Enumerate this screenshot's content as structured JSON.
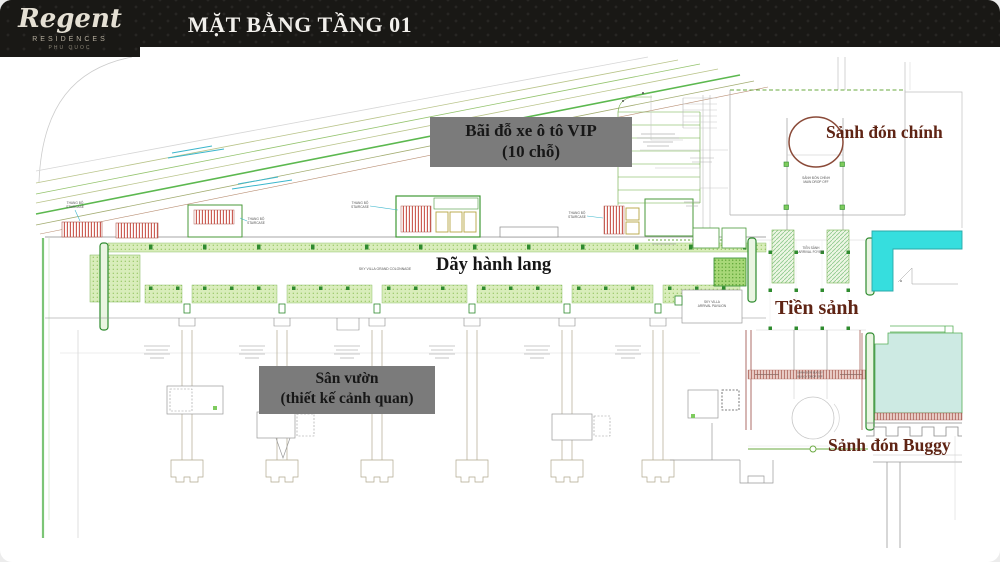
{
  "header": {
    "logo": {
      "script": "Regent",
      "residences": "RESIDENCES",
      "location": "PHU QUOC"
    },
    "title": "MẶT BẰNG TẦNG 01"
  },
  "plan": {
    "callouts": {
      "vip_parking": {
        "line1": "Bãi đỗ xe ô tô VIP",
        "line2": "(10 chỗ)"
      },
      "main_arrival_hall": "Sảnh đón chính",
      "corridor": "Dãy hành lang",
      "foyer": "Tiền sảnh",
      "garden": {
        "line1": "Sân vườn",
        "line2": "(thiết kế cảnh quan)"
      },
      "buggy_hall": "Sảnh đón Buggy"
    },
    "annotations": {
      "colonnade": "SKY VILLA GRAND COLONNADE",
      "pavilion_line1": "SKY VILLA",
      "pavilion_line2": "ARRIVAL PAVILION",
      "foyer_small_line1": "TIỀN SẢNH",
      "foyer_small_line2": "ARRIVAL FOYER",
      "main_drop_line1": "SẢNH ĐÓN CHÍNH",
      "main_drop_line2": "MAIN DROP OFF",
      "buggy_drop_line1": "SẢNH ĐÓN BUGGY",
      "buggy_drop_line2": "BUGGY DROP OFF",
      "stair_line1": "THANG BỘ",
      "stair_line2": "STAIRCASE"
    },
    "colors": {
      "callout_box": "#7b7b7b",
      "maroon_text": "#5f2414",
      "pool_cyan": "#36dede",
      "pool_aqua": "#cdeae3",
      "plan_green": "#58ab45",
      "hatch_red": "#c9544a",
      "road_green": "#5cb84f"
    }
  }
}
